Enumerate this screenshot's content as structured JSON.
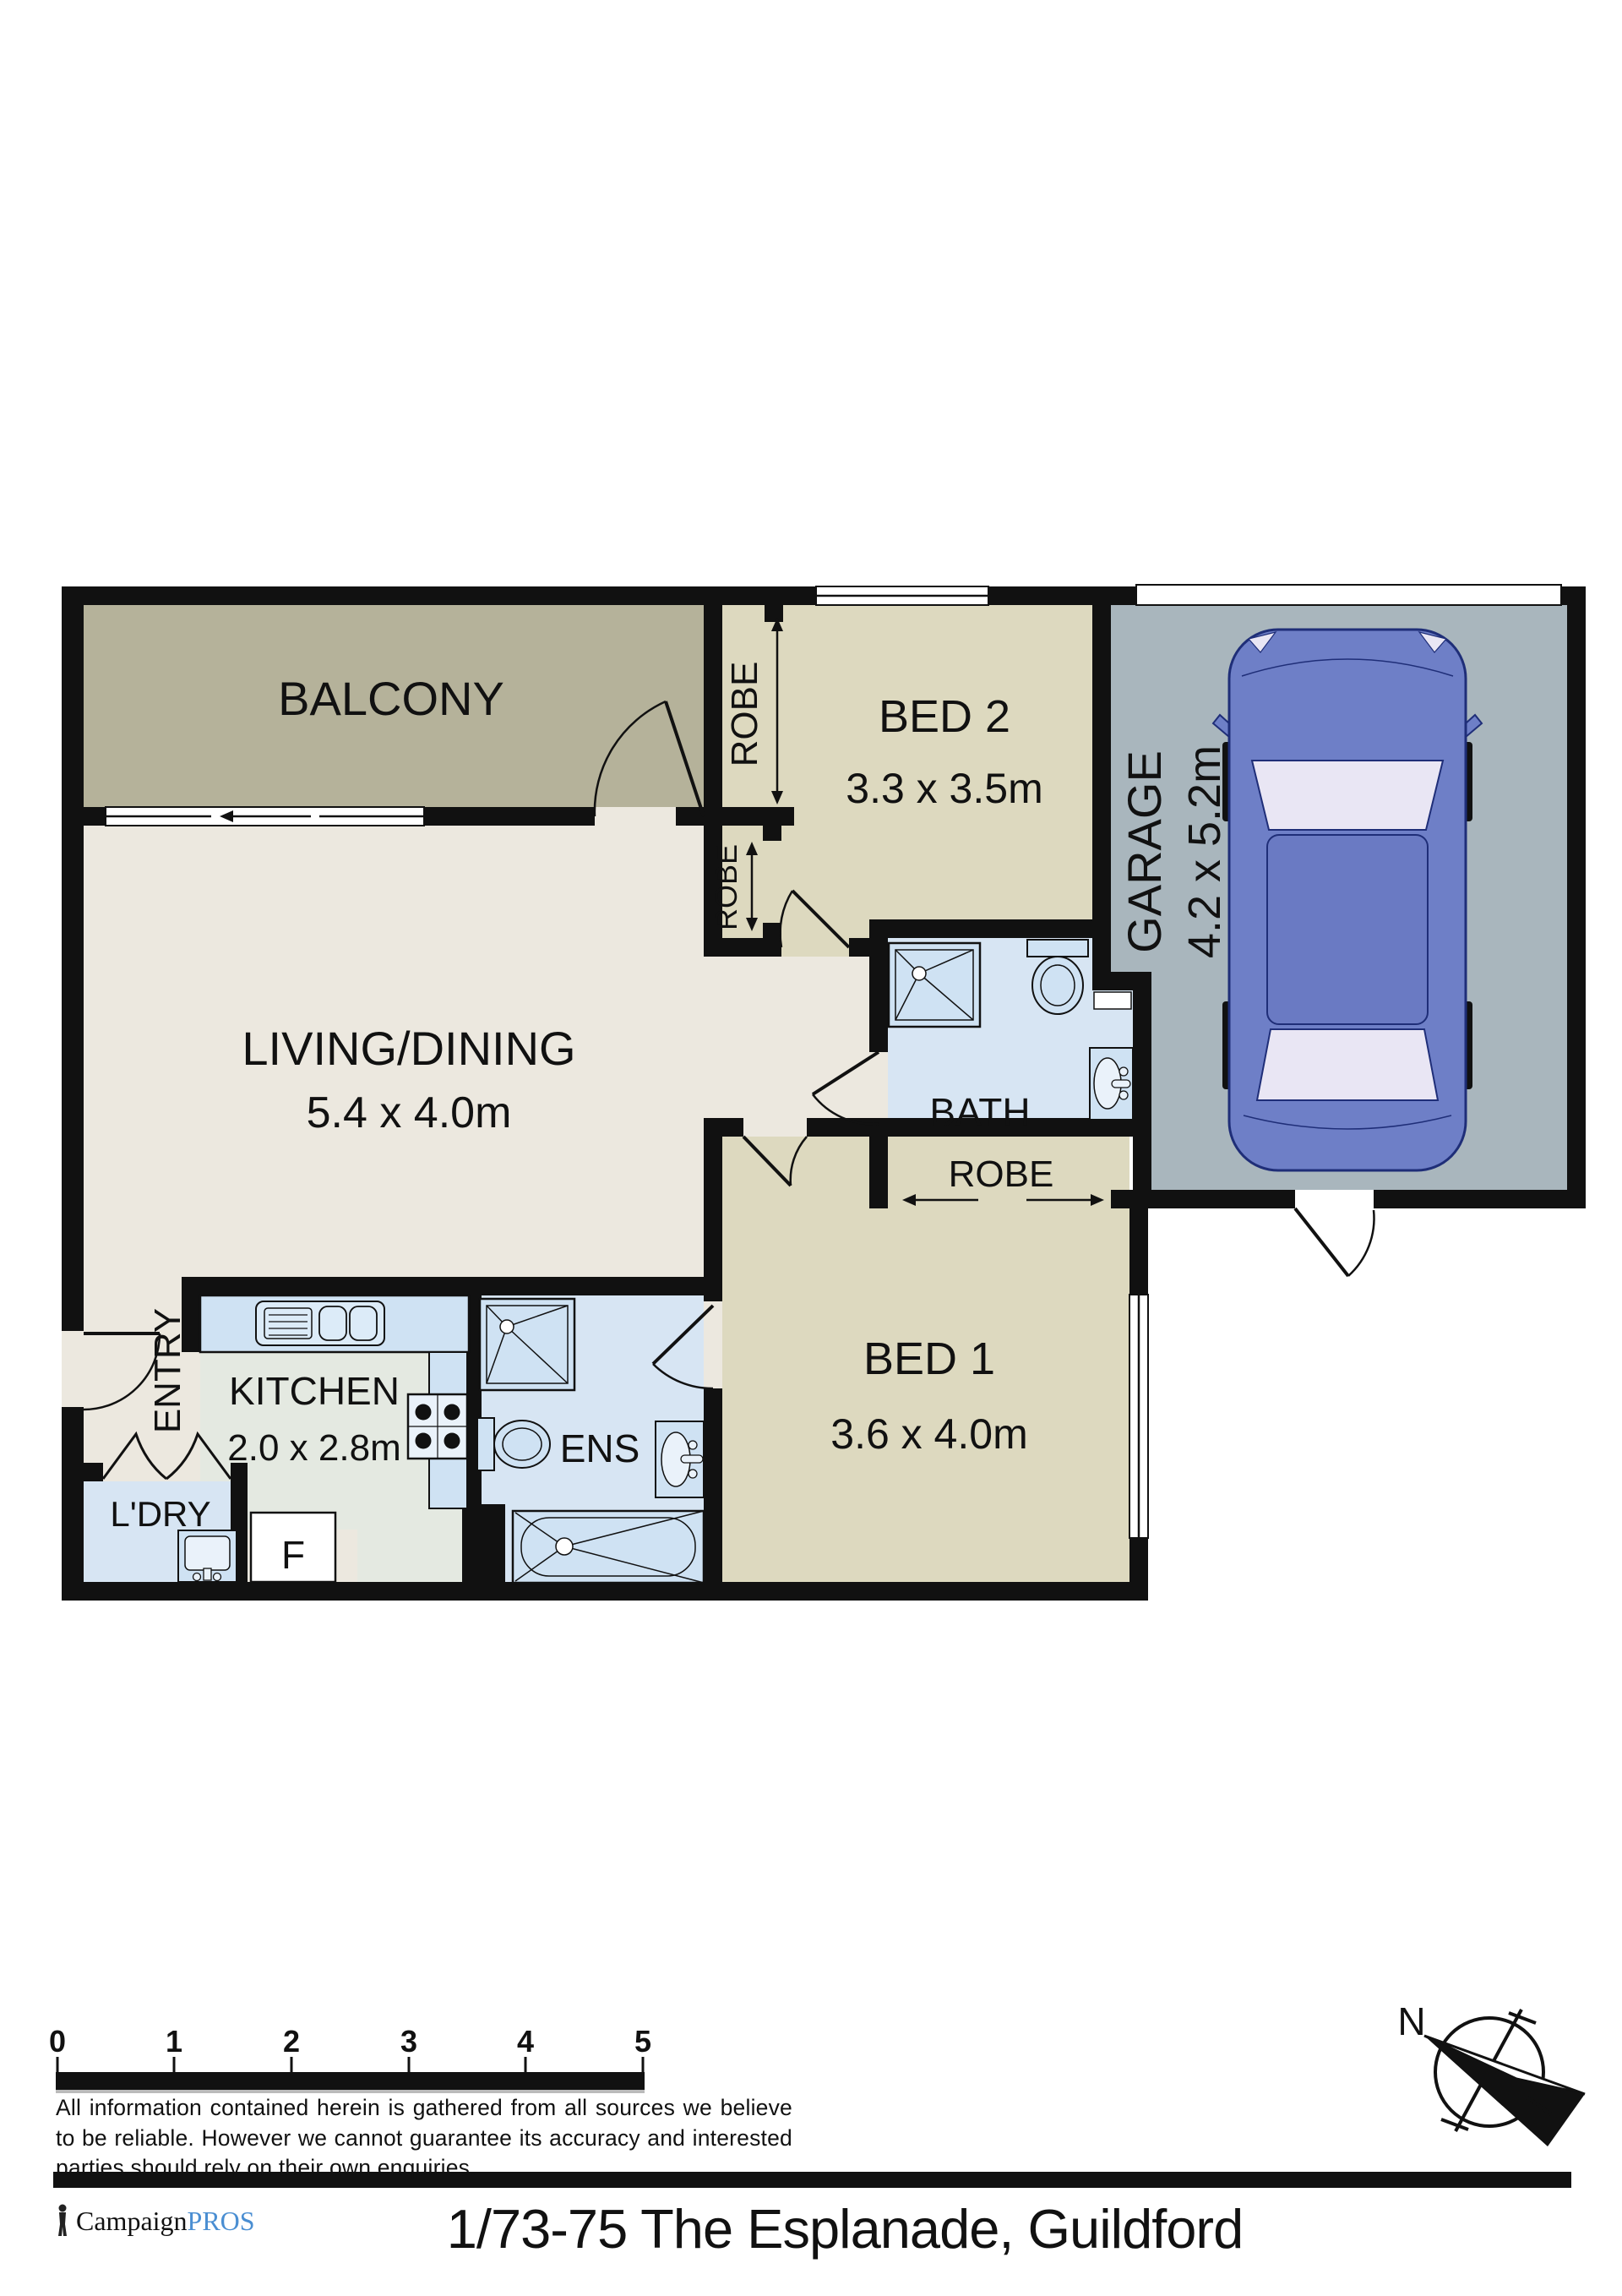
{
  "plan": {
    "rooms": {
      "balcony": {
        "label": "BALCONY"
      },
      "living": {
        "label": "LIVING/DINING",
        "dims": "5.4 x 4.0m"
      },
      "bed2": {
        "label": "BED 2",
        "dims": "3.3 x 3.5m"
      },
      "bed1": {
        "label": "BED 1",
        "dims": "3.6 x 4.0m"
      },
      "garage": {
        "label": "GARAGE",
        "dims": "4.2 x 5.2m"
      },
      "bath": {
        "label": "BATH"
      },
      "ens": {
        "label": "ENS"
      },
      "kitchen": {
        "label": "KITCHEN",
        "dims": "2.0 x 2.8m"
      },
      "entry": {
        "label": "ENTRY"
      },
      "laundry": {
        "label": "L'DRY"
      },
      "fridge": {
        "label": "F"
      },
      "robe_bed2_main": {
        "label": "ROBE"
      },
      "robe_bed2_second": {
        "label": "ROBE"
      },
      "robe_bed1": {
        "label": "ROBE"
      }
    },
    "compass": {
      "north_label": "N"
    },
    "scale_bar": {
      "ticks": [
        "0",
        "1",
        "2",
        "3",
        "4",
        "5"
      ]
    }
  },
  "disclaimer": {
    "text": "All information contained herein is gathered from all sources we believe to be reliable. However we cannot guarantee its accuracy and interested parties should rely on their own enquiries."
  },
  "footer": {
    "brand_name": "Campaign",
    "brand_suffix": "PROS",
    "address": "1/73-75 The Esplanade, Guildford"
  },
  "colors": {
    "wall": "#111111",
    "balcony_floor": "#b5b29a",
    "bedroom_floor": "#ddd9bf",
    "living_floor": "#ece8df",
    "kitchen_floor": "#e4e9e1",
    "wet_area_floor": "#d7e5f3",
    "fixture_fill": "#cfe2f3",
    "garage_floor": "#a9b6bd",
    "car_body": "#6e7fc7",
    "car_glass": "#e9e6f4",
    "brand_blue": "#4a8ed2"
  }
}
